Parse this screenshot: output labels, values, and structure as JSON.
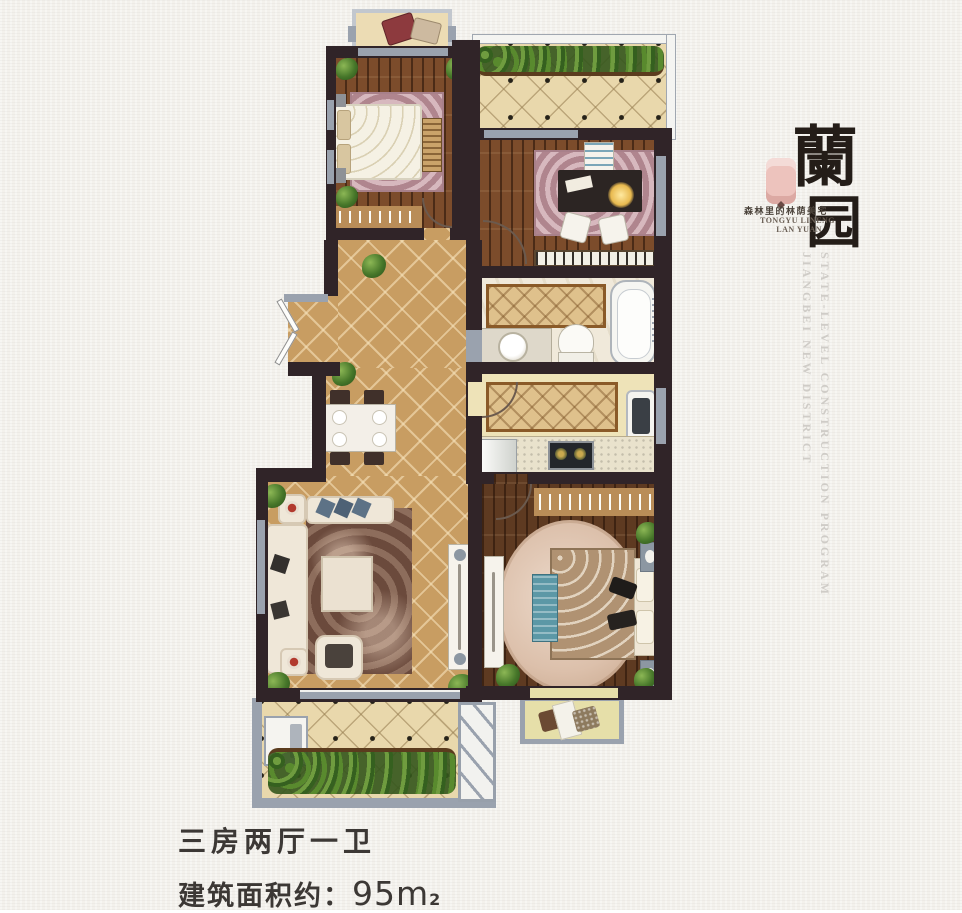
{
  "poster": {
    "background_color": "#f3f1ec",
    "caption": {
      "line1": "三房两厅一卫",
      "line2_label": "建筑面积约：",
      "line2_value": "95m",
      "line2_superscript": "2",
      "text_color": "#3c3835"
    },
    "logo": {
      "char_top": "蘭",
      "char_bottom": "园",
      "tagline_cn": "森林里的林荫美宅",
      "tagline_en_line1": "TONGYU LINENG",
      "tagline_en_line2": "LAN YUAN",
      "seal_color": "#edc3bd",
      "ink_color": "#241d18"
    },
    "side_captions": {
      "column1": "JIANGBEI NEW DISTRICT",
      "column2": "STATE-LEVEL CONSTRUCTION PROGRAM",
      "text_color": "#cfccc7"
    },
    "floorplan_colors": {
      "wall": "#302428",
      "wood_floor": "#7c4c2b",
      "wood_floor_dark": "#5e3a21",
      "tile_gold": "#c89d62",
      "tile_cream": "#e9d8ac",
      "window_gray": "#9aa2ae",
      "plant_green": "#47772a"
    }
  }
}
